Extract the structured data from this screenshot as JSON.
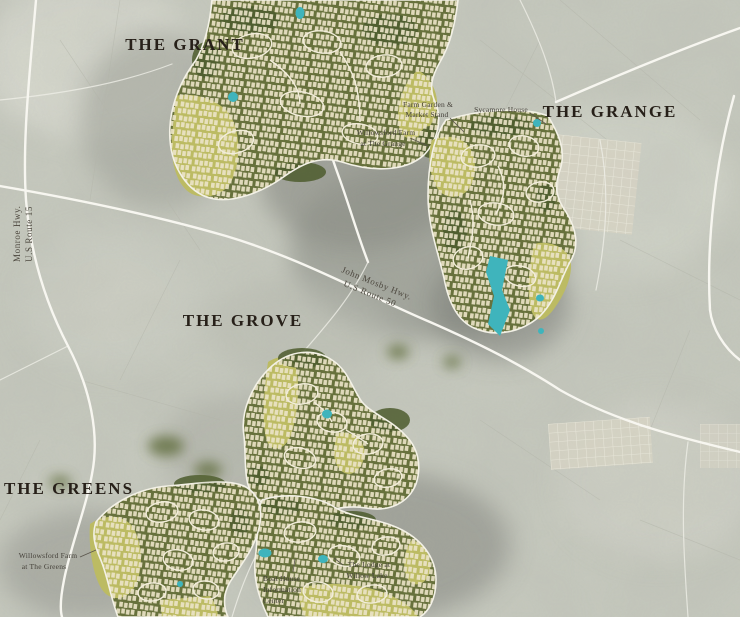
{
  "map": {
    "labels": {
      "villages": [
        {
          "name": "THE GRANT"
        },
        {
          "name": "THE GRANGE"
        },
        {
          "name": "THE GROVE"
        },
        {
          "name": "THE GREENS"
        }
      ],
      "roads": [
        {
          "name": "Monroe Hwy.",
          "route": "U.S Route 15"
        },
        {
          "name": "John Mosby Hwy.",
          "route": "U.S Route 50"
        }
      ],
      "pois": [
        {
          "line1": "Farm Garden &",
          "line2": "Market Stand"
        },
        {
          "line1": "Sycamore House"
        },
        {
          "line1": "Willowsford Farm",
          "line2": "at The Grange"
        },
        {
          "line1": "Willowsford Farm",
          "line2": "at The Greens"
        },
        {
          "line1": "Boat House",
          "line2": "Information",
          "line3": "Center"
        },
        {
          "line1": "The Lodge at",
          "line2": "Willow Lake"
        }
      ]
    },
    "colors": {
      "background": "#c7cabf",
      "development_green": "#67713c",
      "forest_green": "#4d5c2e",
      "field_yellow": "#bcbb63",
      "water_teal": "#3fb4bc",
      "road_white": "#f7f6f0",
      "lot_cream": "#ece4c8",
      "title_text": "#272019",
      "small_text": "#45413a"
    }
  }
}
